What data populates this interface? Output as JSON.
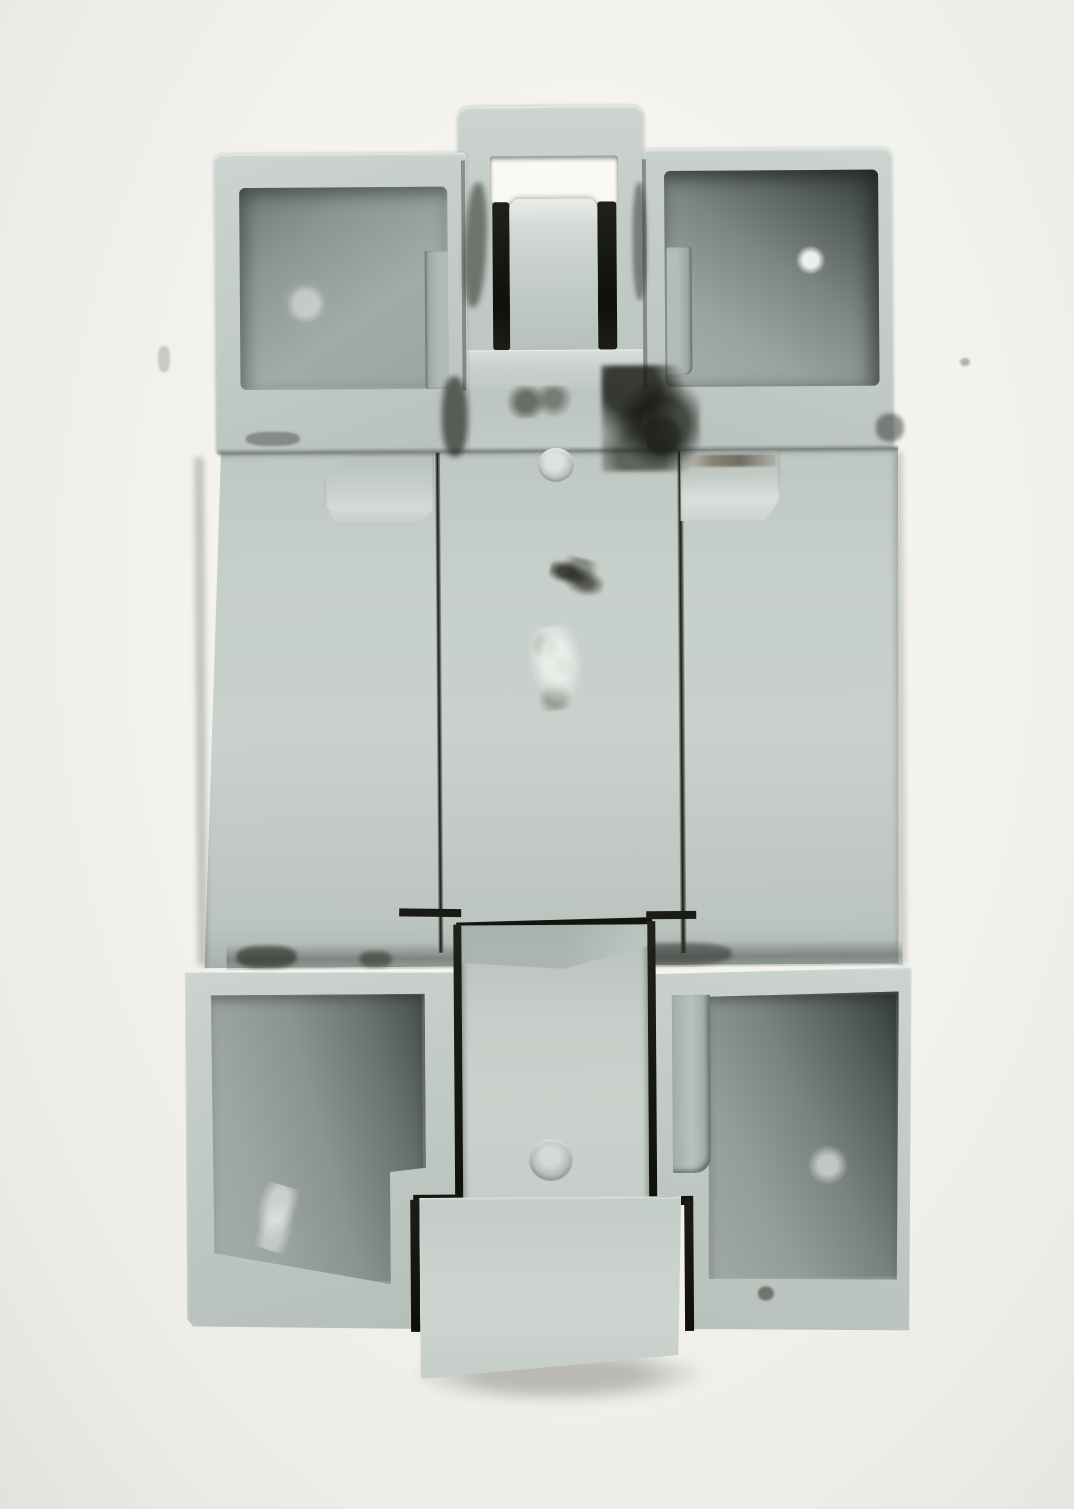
{
  "image": {
    "type": "product-photo",
    "subject": "Rear view of a gray plastic DIN-rail mount electrical module on a plain white background",
    "orientation": "portrait",
    "visible_text": "none"
  },
  "palette": {
    "background_white": "#f4f3ef",
    "background_shade": "#e3e2de",
    "plastic_body": "#c3cbc6",
    "plastic_highlight": "#d6dcd8",
    "recess_mid": "#9aa39f",
    "recess_dark": "#575f5d",
    "recess_deep": "#353d3b",
    "slot_black": "#141510",
    "grime_dark": "#26271f",
    "grime_brown": "#6e5a41",
    "window_white": "#faf9f5"
  },
  "parts": {
    "device": "Gray plastic module, rear side",
    "top_clip": "Top mounting clip",
    "top_clip_window": "Rectangular cut-out window showing background",
    "slot_left": "Left black spring slot",
    "slot_right": "Right black spring slot",
    "top_clip_tongue": "Center flex tongue of top clip",
    "top_clip_ledge": "Bottom ledge of top clip",
    "pocket_top_left": "Top-left recessed mounting pocket",
    "pocket_top_right": "Top-right recessed mounting pocket",
    "back_panel": "Flat rear panel with seam grooves",
    "groove_left": "Left vertical seam groove",
    "groove_right": "Right vertical seam groove",
    "mold_tab_left": "Small molded tab under top-left pocket",
    "mold_tab_right": "Small molded tab under top-right pocket",
    "pin_mark_top": "Round ejector-pin mark (upper)",
    "pin_mark_bottom": "Round ejector-pin mark (lower, on slider)",
    "pocket_bottom_left": "Bottom-left recessed pocket with notched corner",
    "pocket_bottom_right": "Bottom-right recessed pocket with notched corner",
    "din_slider": "Sliding DIN-rail latch",
    "slider_tongue": "Slider pull tab extending past bottom edge",
    "grime": "Black dirt smudges around clip and seams",
    "scuff": "Light scuff and scratch marks",
    "shadow": "Soft contact shadow"
  }
}
